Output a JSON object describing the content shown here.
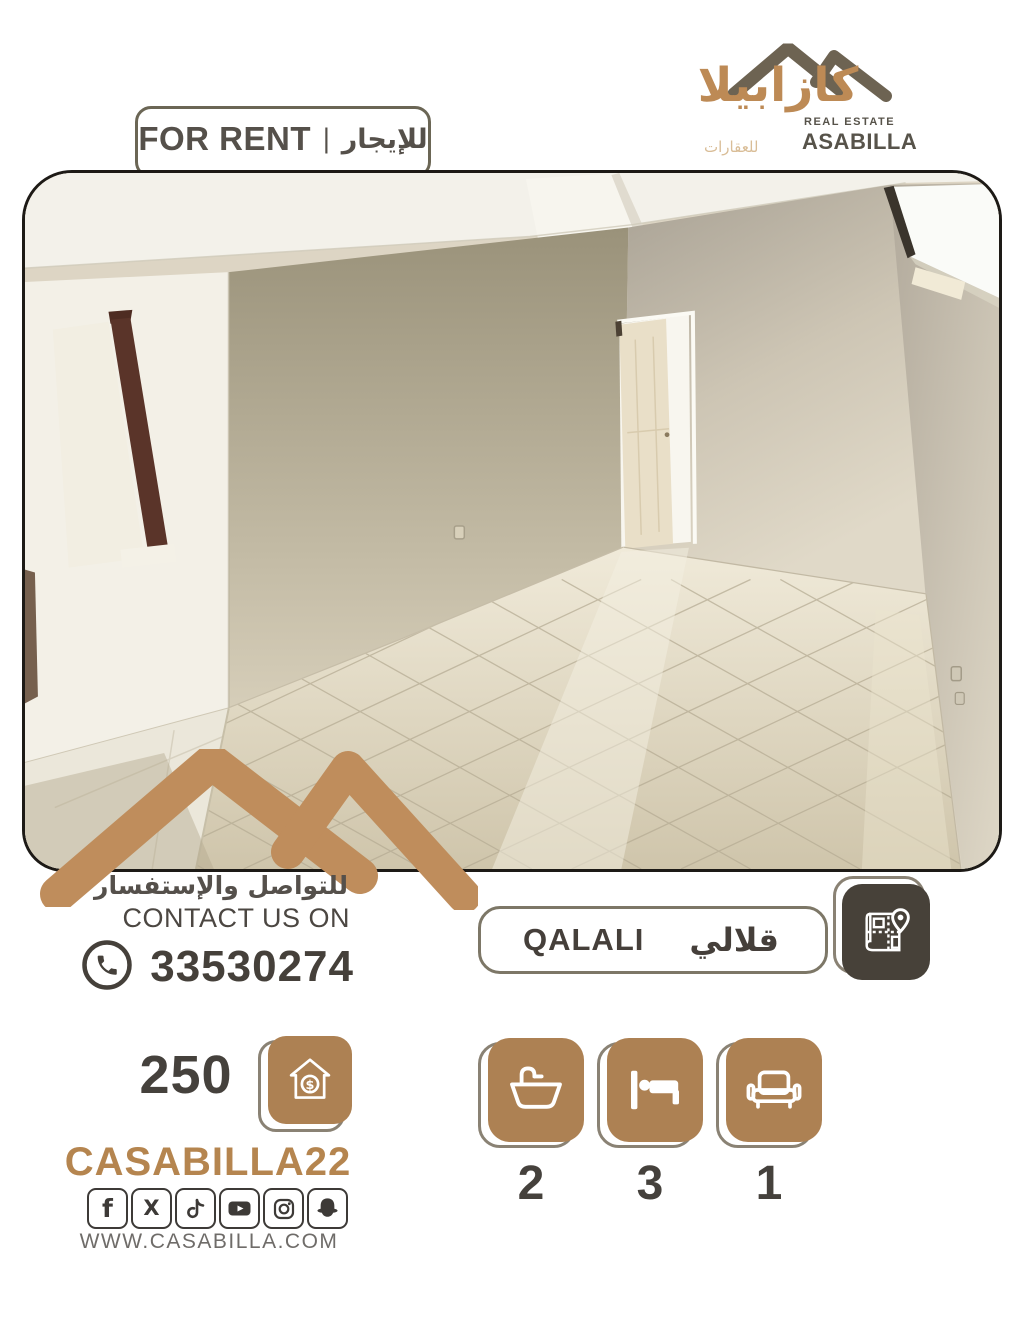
{
  "brand": {
    "name_ar": "كازابيلا",
    "tagline": "REAL ESTATE",
    "name_en": "ASABILLA",
    "sub_ar": "للعقارات"
  },
  "banner": {
    "en": "FOR RENT",
    "divider": "|",
    "ar": "للإيجار"
  },
  "photo": {
    "alt": "Empty apartment interior with beige walls, open doors and glossy tiled floor"
  },
  "contact": {
    "heading_ar": "للتواصل والإستفسار",
    "heading_en": "CONTACT US ON",
    "phone": "33530274"
  },
  "location": {
    "en": "QALALI",
    "ar": "قلالي"
  },
  "price": {
    "amount": "250"
  },
  "amenities": [
    {
      "name": "bathrooms",
      "count": "2"
    },
    {
      "name": "bedrooms",
      "count": "3"
    },
    {
      "name": "living-rooms",
      "count": "1"
    }
  ],
  "social": {
    "handle": "CASABILLA22",
    "website": "WWW.CASABILLA.COM",
    "platforms": [
      "facebook",
      "x",
      "tiktok",
      "youtube",
      "instagram",
      "snapchat"
    ]
  },
  "colors": {
    "accent_tan": "#b5854f",
    "tile_brown": "#ad8153",
    "mountain_tan": "#bf8d5c",
    "logo_olive": "#6d6352",
    "dark_text": "#45413c",
    "badge_border": "#7d7767",
    "map_tile_bg": "#474139",
    "icon_dark": "#3d3a37"
  }
}
